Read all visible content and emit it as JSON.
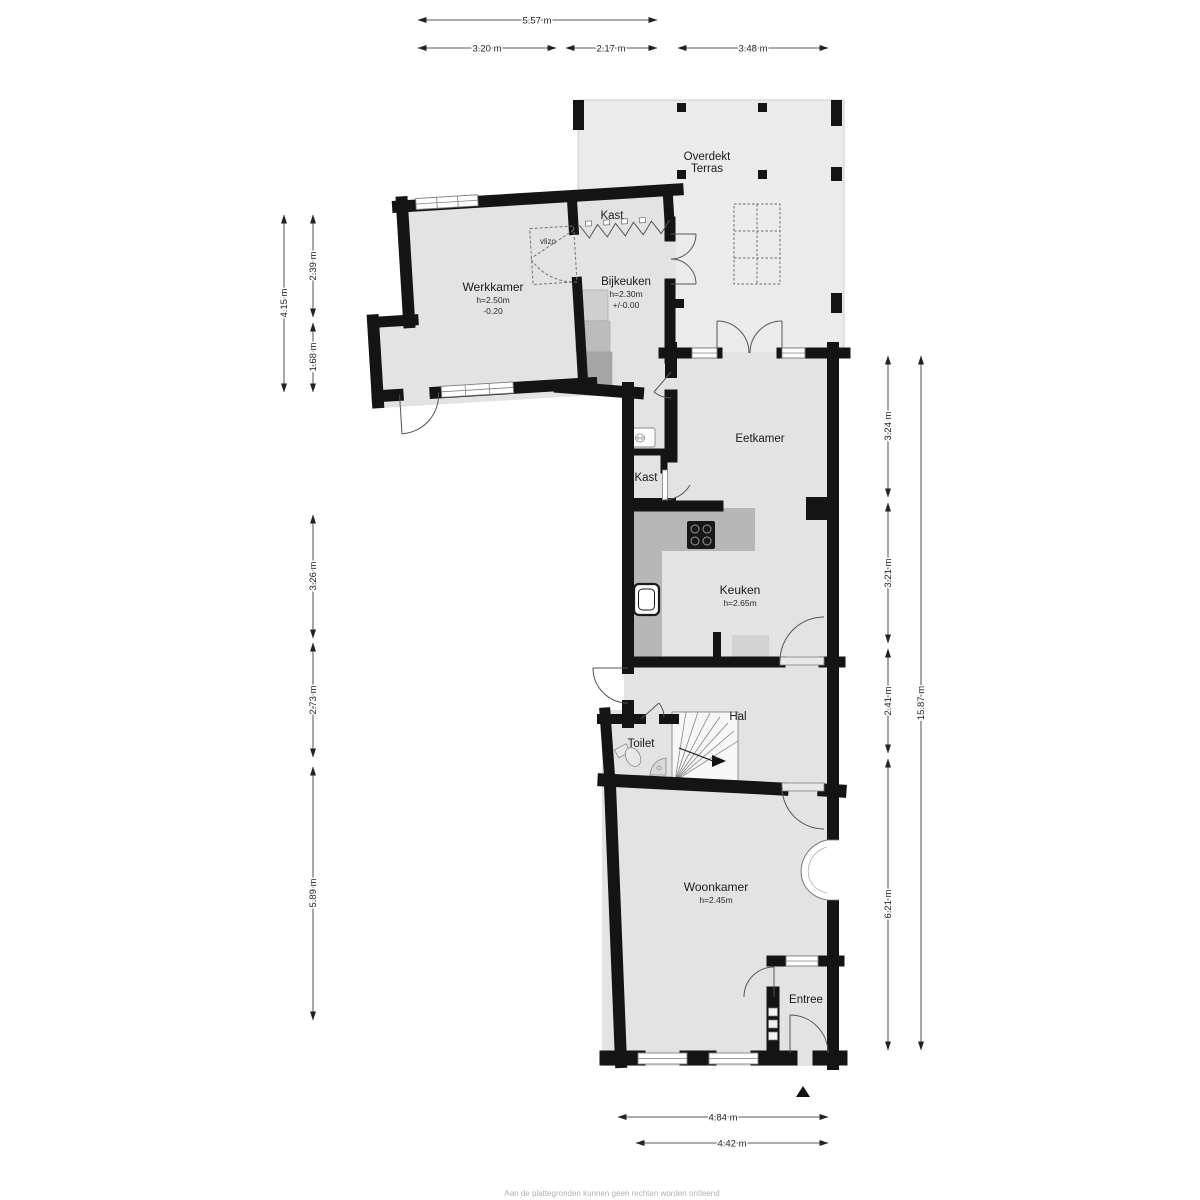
{
  "rooms": {
    "terras": {
      "line1": "Overdekt",
      "line2": "Terras"
    },
    "kast_top": {
      "name": "Kast"
    },
    "werkkamer": {
      "name": "Werkkamer",
      "height": "h=2.50m",
      "level": "-0.20"
    },
    "vlizo": {
      "name": "vlizo"
    },
    "bijkeuken": {
      "name": "Bijkeuken",
      "height": "h=2.30m",
      "level": "+/-0.00"
    },
    "eetkamer": {
      "name": "Eetkamer"
    },
    "kast_mid": {
      "name": "Kast"
    },
    "keuken": {
      "name": "Keuken",
      "height": "h=2.65m"
    },
    "hal": {
      "name": "Hal"
    },
    "toilet": {
      "name": "Toilet"
    },
    "woonkamer": {
      "name": "Woonkamer",
      "height": "h=2.45m"
    },
    "entree": {
      "name": "Entree"
    }
  },
  "dimensions": {
    "top_total": "5.57 m",
    "top_1": "3.20 m",
    "top_2": "2.17 m",
    "top_3": "3.48 m",
    "left_1": "4.15 m",
    "left_2": "2.39 m",
    "left_3": "1.68 m",
    "left_4": "3.26 m",
    "left_5": "2.73 m",
    "left_6": "5.89 m",
    "right_1": "3.24 m",
    "right_2": "3.21 m",
    "right_3": "2.41 m",
    "right_4": "6.21 m",
    "right_total": "15.87 m",
    "bottom_1": "4.84 m",
    "bottom_2": "4.42 m"
  },
  "footer": {
    "disclaimer": "Aan de plattegronden kunnen geen rechten worden ontleend"
  },
  "colors": {
    "wall": "#141414",
    "room_fill": "#e3e3e3",
    "terrace_fill": "#ebebeb",
    "counter_fill": "#b7b7b7",
    "cooktop_fill": "#181818"
  }
}
